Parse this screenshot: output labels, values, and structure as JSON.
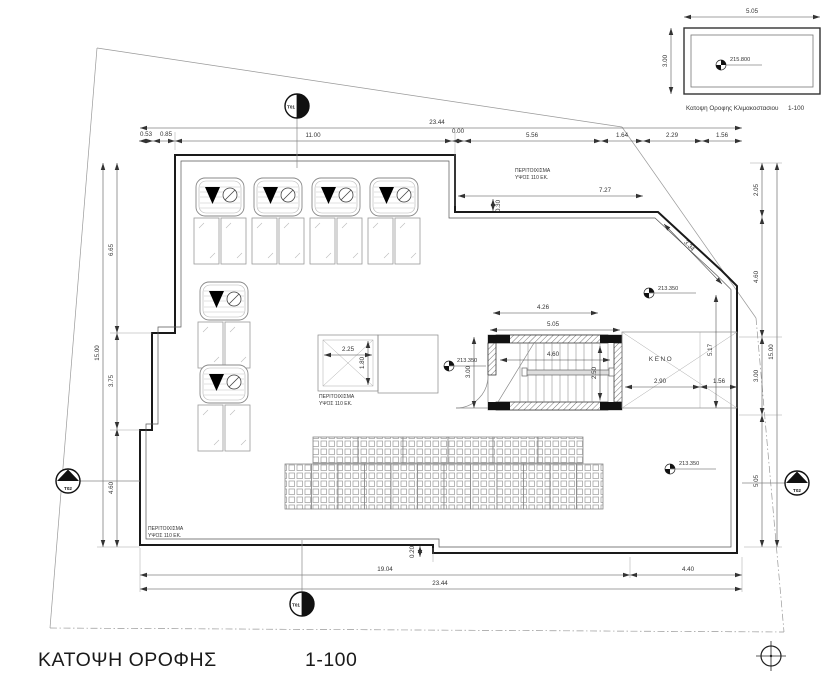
{
  "title": {
    "name": "ΚΑΤΟΨΗ ΟΡΟΦΗΣ",
    "scale": "1-100"
  },
  "inset": {
    "caption": "Κατοψη Οροφης Κλιμακοστασιου",
    "scale": "1-100",
    "width": "5.05",
    "height": "3.00",
    "level": "215.800"
  },
  "labels": {
    "parapet_line1": "ΠΕΡΙΤΟΙΧΙΣΜΑ",
    "parapet_line2": "ΥΨΟΣ 110 ΕΚ.",
    "void": "ΚΕΝΟ",
    "roof_level": "213.350"
  },
  "markers": {
    "t01": "T01",
    "t02": "T02"
  },
  "dims": {
    "top_total": "23.44",
    "top_a": "0.53",
    "top_b": "0.85",
    "top_c": "11.00",
    "top_d": "0.00",
    "top_e": "5.56",
    "top_f": "1.64",
    "top_g": "2.29",
    "top_h": "1.56",
    "upper_width": "7.27",
    "upper_step": "0.30",
    "diagonal": "3.34",
    "right_a": "2.05",
    "right_b": "4.60",
    "right_c": "3.00",
    "right_d": "5.05",
    "right_total": "15.00",
    "shaft_height": "5.17",
    "shaft_gap": "1.56",
    "left_total": "15.00",
    "left_a": "6.65",
    "left_b": "3.75",
    "left_c": "4.60",
    "stair_top": "4.26",
    "stair_outer": "5.05",
    "stair_width": "4.60",
    "stair_depth": "2.50",
    "stair_left": "3.00",
    "void_width": "2.90",
    "skylight_width": "2.25",
    "skylight_height": "1.80",
    "bottom_left": "19.04",
    "bottom_right": "4.40",
    "bottom_total": "23.44",
    "bottom_step": "0.20"
  }
}
